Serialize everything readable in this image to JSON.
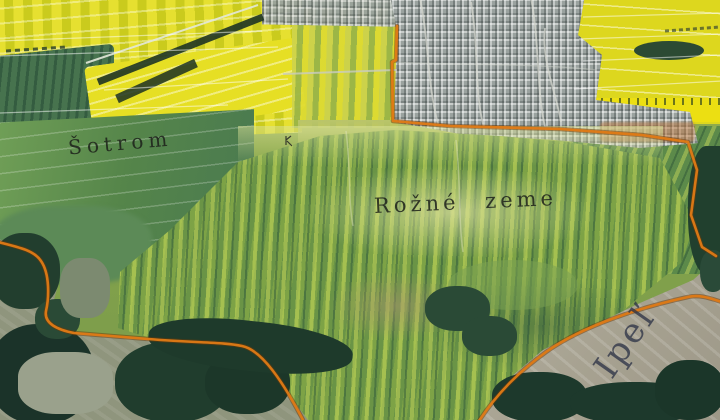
{
  "map": {
    "type": "oblique-aerial-cadastral-map",
    "labels": {
      "region_left": "Šotrom",
      "region_center": "Rožné zeme",
      "river": "Ipeľ"
    },
    "features": {
      "village_area": "settlement of grey-roofed buildings, top center",
      "boundary": "orange cadastral boundary line",
      "marker": "k-marker"
    },
    "colors": {
      "rapeseed_yellow": "#ddd71e",
      "crop_green": "#6a9446",
      "forest_dark_green": "#203d2d",
      "village_grey": "#9aa29c",
      "river_grey_tan": "#aaa596",
      "boundary_orange": "#e07a15",
      "meadow_grey_green": "#8f957d"
    }
  }
}
